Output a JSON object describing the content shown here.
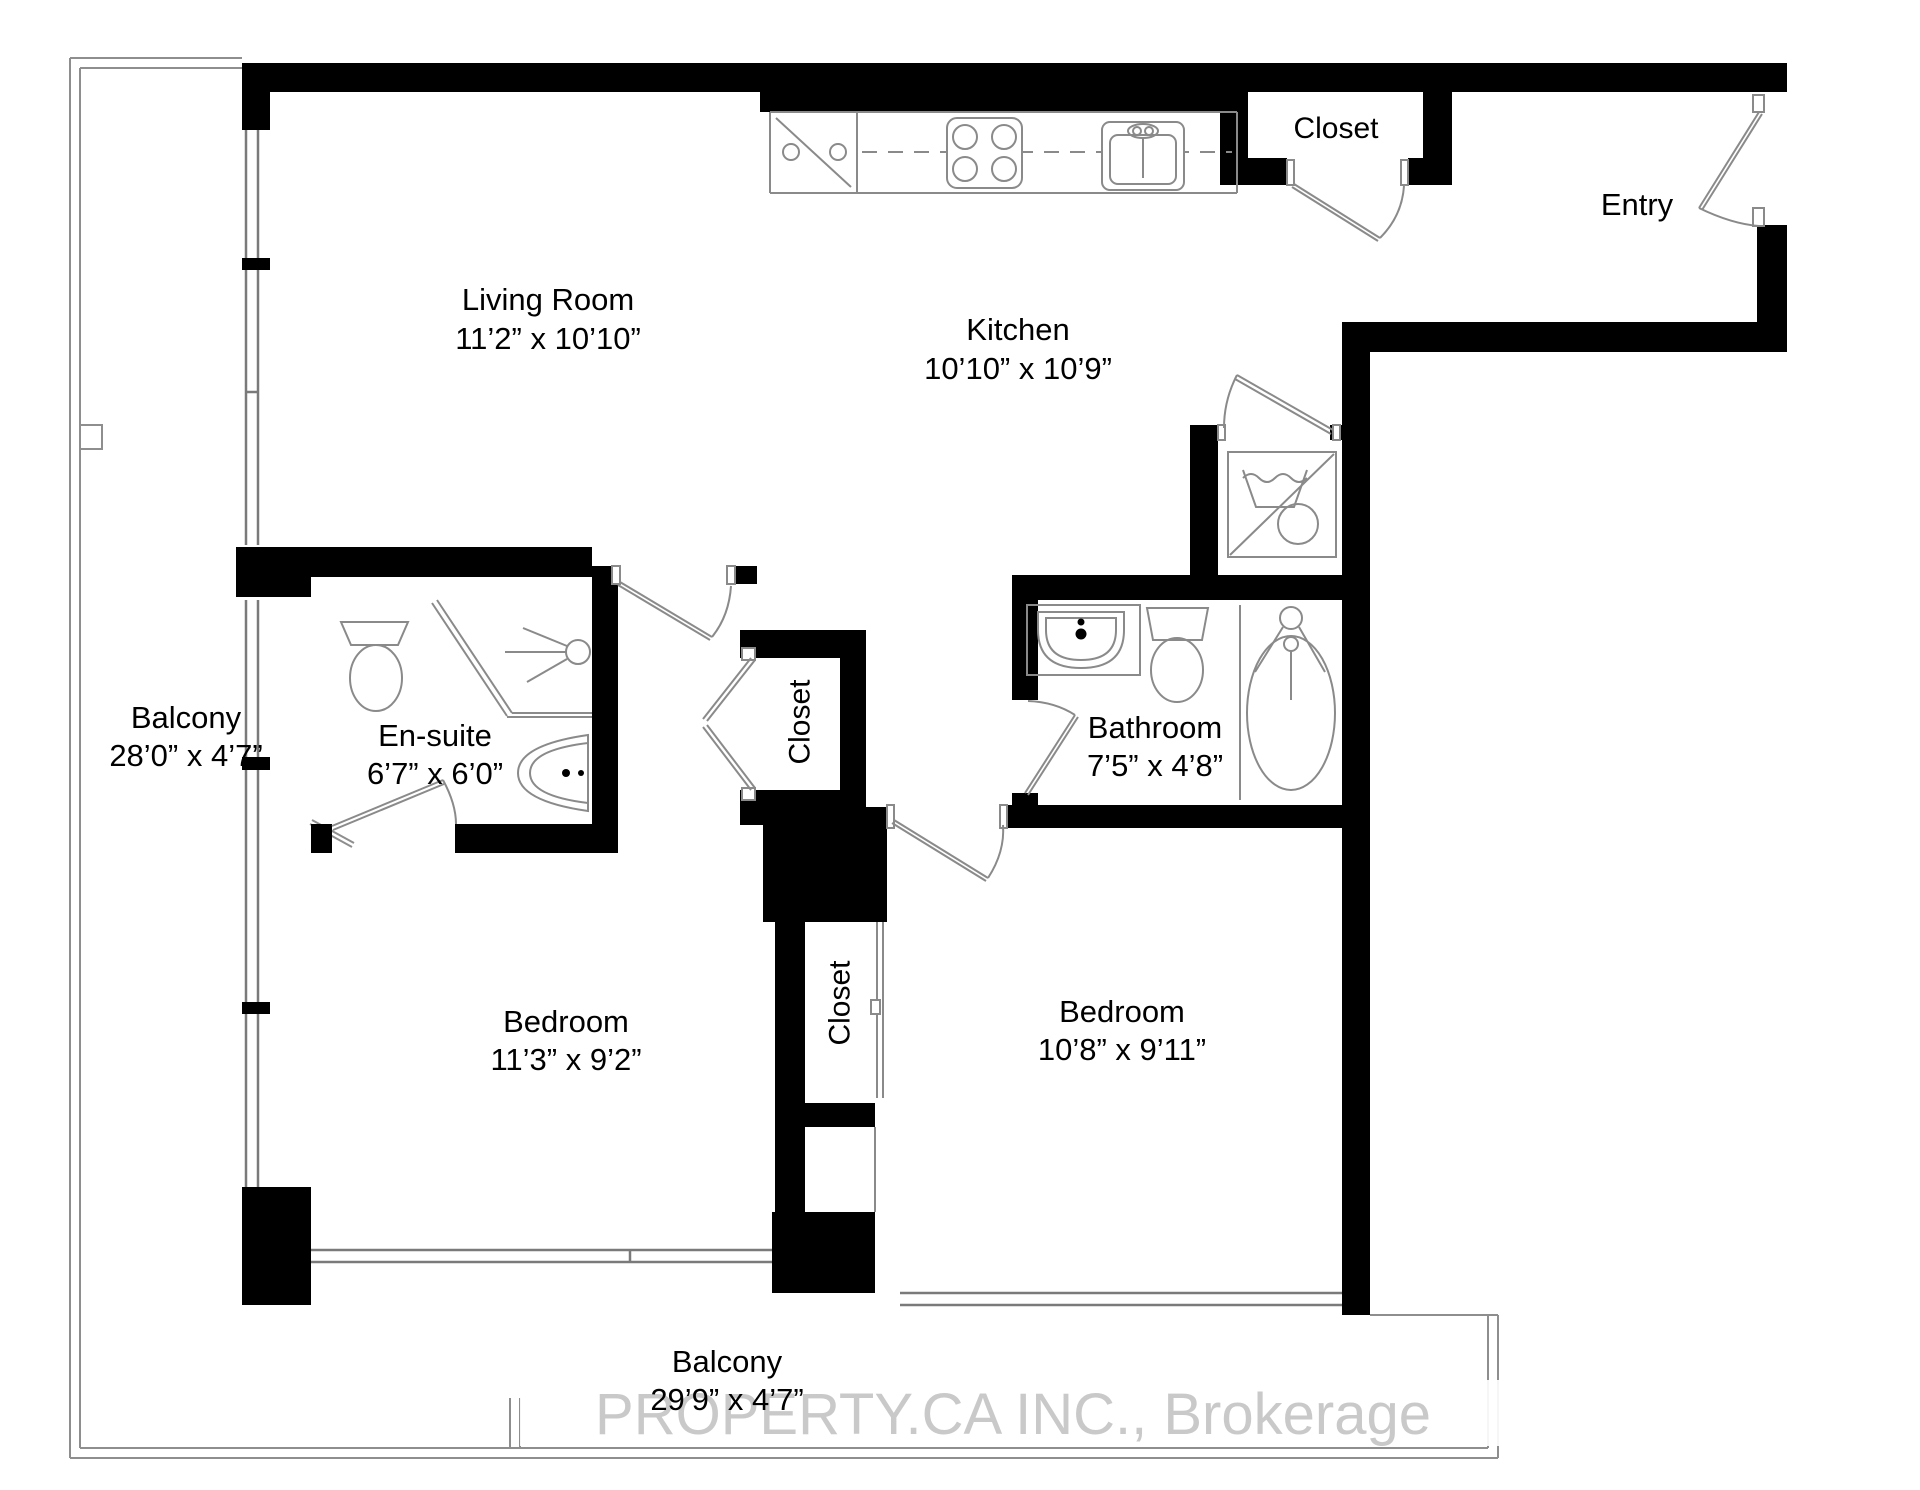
{
  "floorplan": {
    "watermark": "PROPERTY.CA INC., Brokerage",
    "colors": {
      "wall": "#000000",
      "fixture_line": "#8a8a8a",
      "balcony_line": "#8e8e8e",
      "watermark": "#c9c9c9",
      "text": "#000000"
    },
    "rooms": {
      "living_room": {
        "label": "Living Room",
        "dims": "11’2” x 10’10”"
      },
      "kitchen": {
        "label": "Kitchen",
        "dims": "10’10” x 10’9”"
      },
      "entry": {
        "label": "Entry"
      },
      "closet_entry": {
        "label": "Closet"
      },
      "closet_hall": {
        "label": "Closet"
      },
      "closet_bedroom": {
        "label": "Closet"
      },
      "ensuite": {
        "label": "En-suite",
        "dims": "6’7” x 6’0”"
      },
      "bathroom": {
        "label": "Bathroom",
        "dims": "7’5” x 4’8”"
      },
      "bedroom_left": {
        "label": "Bedroom",
        "dims": "11’3” x 9’2”"
      },
      "bedroom_right": {
        "label": "Bedroom",
        "dims": "10’8” x 9’11”"
      },
      "balcony_left": {
        "label": "Balcony",
        "dims": "28’0” x 4’7”"
      },
      "balcony_bottom": {
        "label": "Balcony",
        "dims": "29’9” x 4’7”"
      }
    }
  }
}
